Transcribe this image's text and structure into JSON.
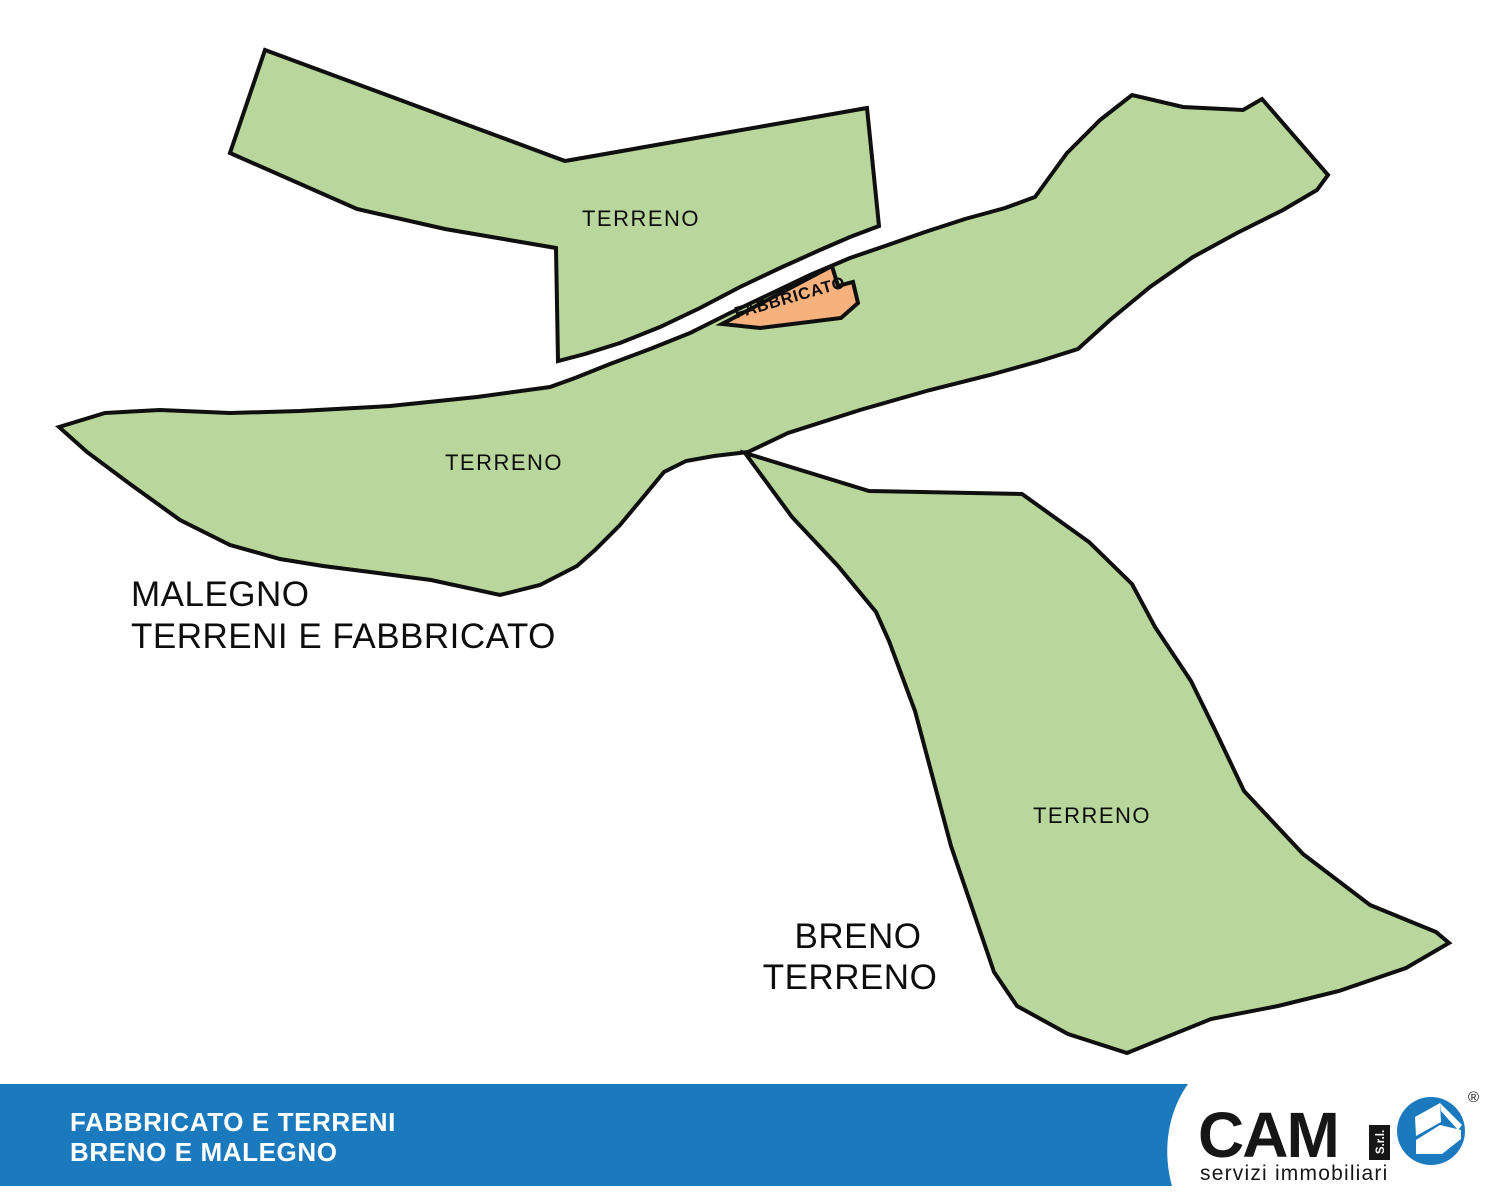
{
  "map": {
    "parcel_labels": {
      "upper": "TERRENO",
      "band": "TERRENO",
      "breno": "TERRENO",
      "building": "FABBRICATO"
    },
    "titles": {
      "malegno_line1": "MALEGNO",
      "malegno_line2": "TERRENI E FABBRICATO",
      "breno_line1": "BRENO",
      "breno_line2": "TERRENO"
    }
  },
  "footer": {
    "line1": "FABBRICATO E TERRENI",
    "line2": "BRENO E MALEGNO",
    "logo": {
      "brand": "CAM",
      "company_suffix": "S.r.l.",
      "tagline": "servizi immobiliari",
      "registered_mark": "®",
      "icon": "house-icon"
    }
  },
  "colors": {
    "terrain_fill": "#b9d79c",
    "building_fill": "#f6b17d",
    "outline": "#0f0f0f",
    "footer_bar": "#1b79be",
    "logo_circle": "#1b79be",
    "logo_black": "#161616",
    "label_text": "#0d0d0d",
    "footer_text": "#ffffff",
    "panel_white": "#ffffff"
  }
}
